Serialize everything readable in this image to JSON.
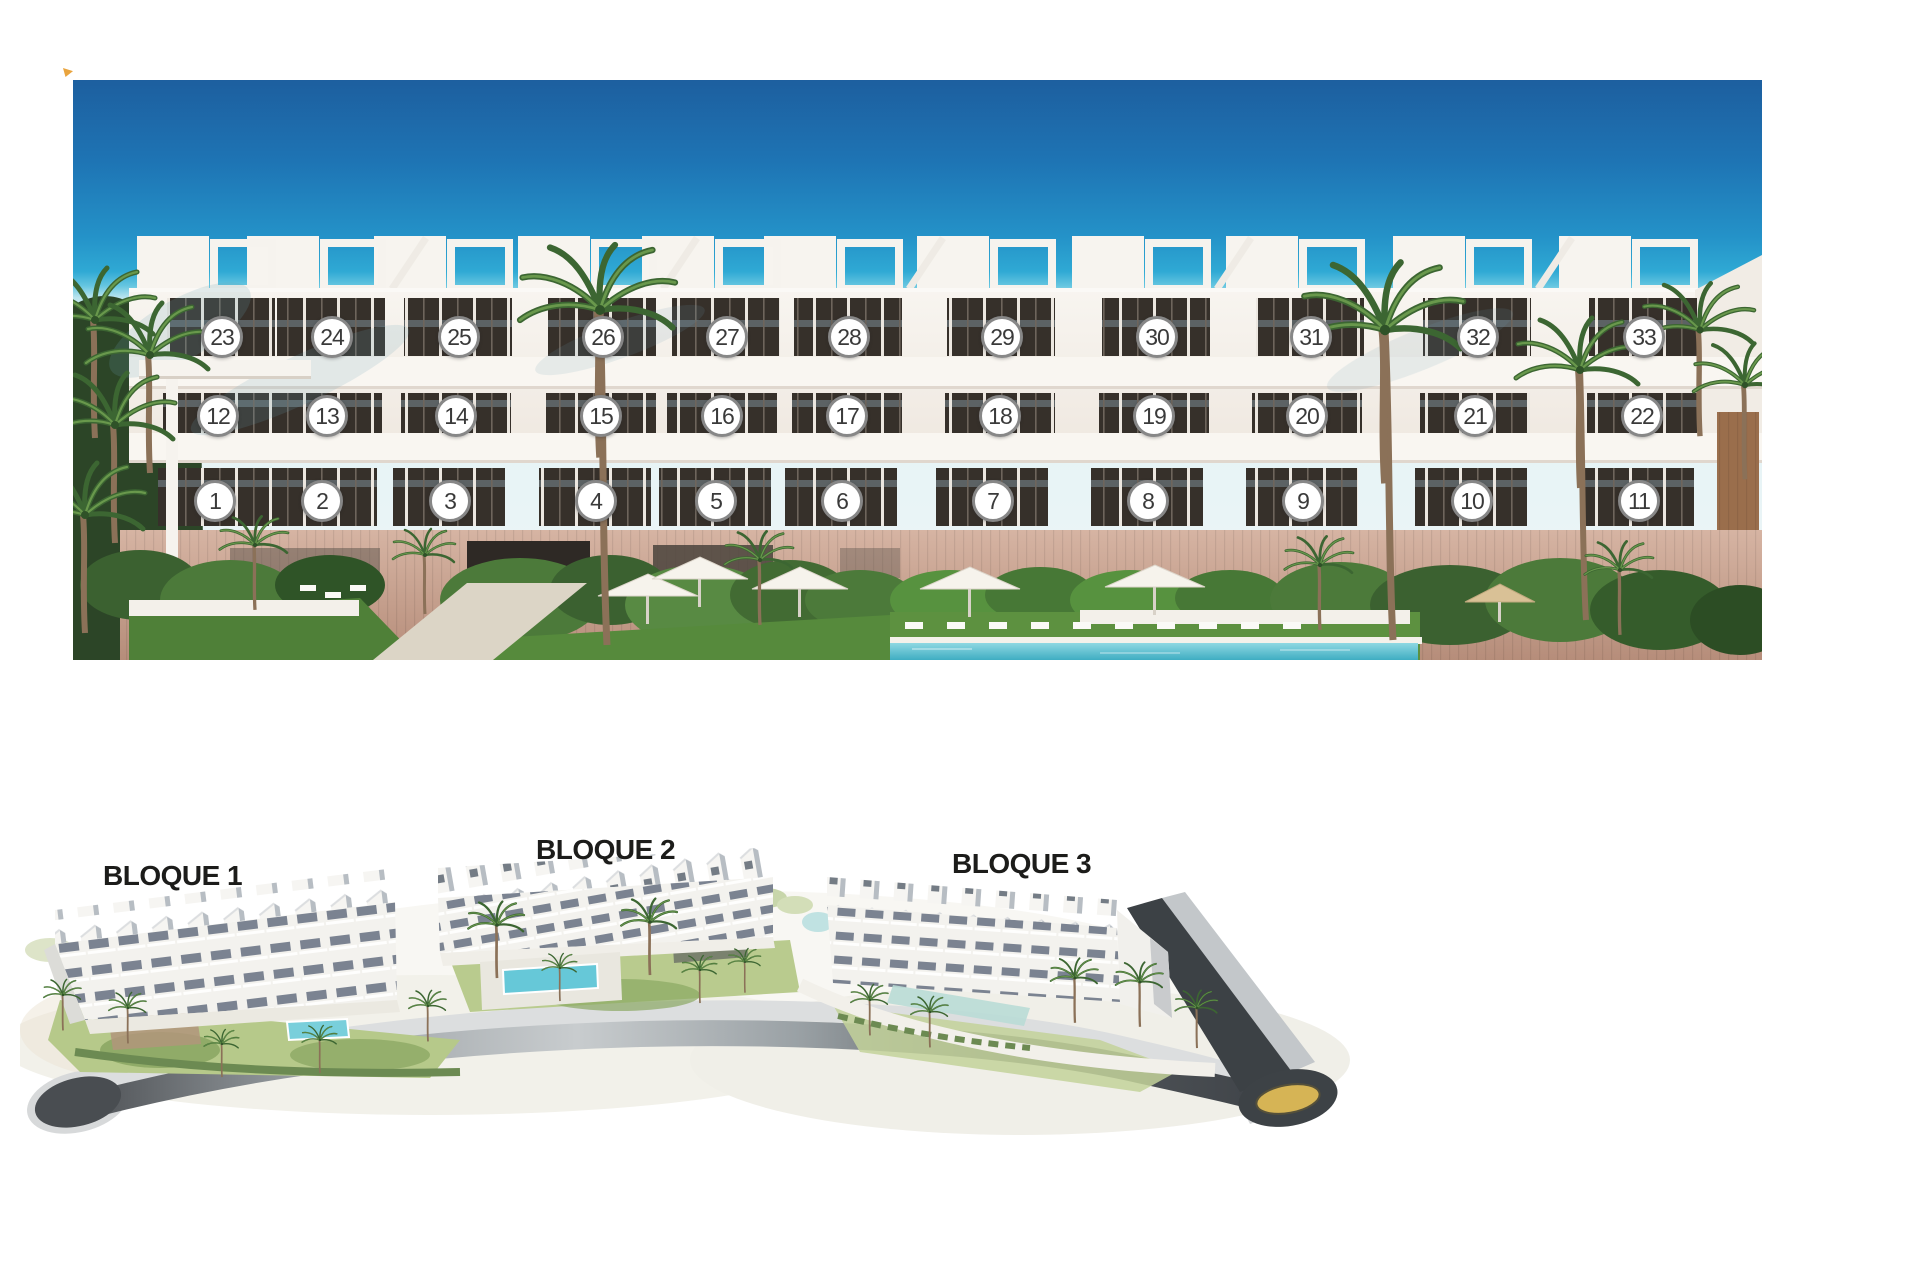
{
  "colors": {
    "page_bg": "#ffffff",
    "sky_top": "#1d5f9f",
    "sky_cyan": "#2fa9d4",
    "sky_horizon_haze": "#e2f2f5",
    "building_white": "#f5f2ec",
    "window_dark": "#36302a",
    "stone_base": "#c9a28f",
    "vegetation_green": "#4c7a3a",
    "lawn_green": "#4f8038",
    "pool_water": "#5ec5d6",
    "badge_bg": "#ffffff",
    "badge_border": "#878787",
    "badge_text": "#3a3a3a",
    "label_text": "#1c1c1a",
    "road_dark": "#3e4247",
    "road_light": "#c8ccce",
    "roundabout_center": "#d6b455",
    "site_pool": "#6fc9d8"
  },
  "front_elevation": {
    "rows": [
      {
        "level": "top-floor",
        "y": 337,
        "units": [
          {
            "n": "23",
            "x": 222
          },
          {
            "n": "24",
            "x": 332
          },
          {
            "n": "25",
            "x": 459
          },
          {
            "n": "26",
            "x": 603
          },
          {
            "n": "27",
            "x": 727
          },
          {
            "n": "28",
            "x": 849
          },
          {
            "n": "29",
            "x": 1002
          },
          {
            "n": "30",
            "x": 1157
          },
          {
            "n": "31",
            "x": 1311
          },
          {
            "n": "32",
            "x": 1478
          },
          {
            "n": "33",
            "x": 1644
          }
        ]
      },
      {
        "level": "middle-floor",
        "y": 416,
        "units": [
          {
            "n": "12",
            "x": 218
          },
          {
            "n": "13",
            "x": 327
          },
          {
            "n": "14",
            "x": 456
          },
          {
            "n": "15",
            "x": 601
          },
          {
            "n": "16",
            "x": 722
          },
          {
            "n": "17",
            "x": 847
          },
          {
            "n": "18",
            "x": 1000
          },
          {
            "n": "19",
            "x": 1154
          },
          {
            "n": "20",
            "x": 1307
          },
          {
            "n": "21",
            "x": 1475
          },
          {
            "n": "22",
            "x": 1642
          }
        ]
      },
      {
        "level": "ground-floor",
        "y": 501,
        "units": [
          {
            "n": "1",
            "x": 215
          },
          {
            "n": "2",
            "x": 322
          },
          {
            "n": "3",
            "x": 450
          },
          {
            "n": "4",
            "x": 596
          },
          {
            "n": "5",
            "x": 716
          },
          {
            "n": "6",
            "x": 842
          },
          {
            "n": "7",
            "x": 993
          },
          {
            "n": "8",
            "x": 1148
          },
          {
            "n": "9",
            "x": 1303
          },
          {
            "n": "10",
            "x": 1472
          },
          {
            "n": "11",
            "x": 1639
          }
        ]
      }
    ]
  },
  "site_plan": {
    "blocks": [
      {
        "label": "BLOQUE 1",
        "label_x": 103,
        "label_y": 862
      },
      {
        "label": "BLOQUE 2",
        "label_x": 536,
        "label_y": 836
      },
      {
        "label": "BLOQUE 3",
        "label_x": 952,
        "label_y": 850
      }
    ]
  }
}
